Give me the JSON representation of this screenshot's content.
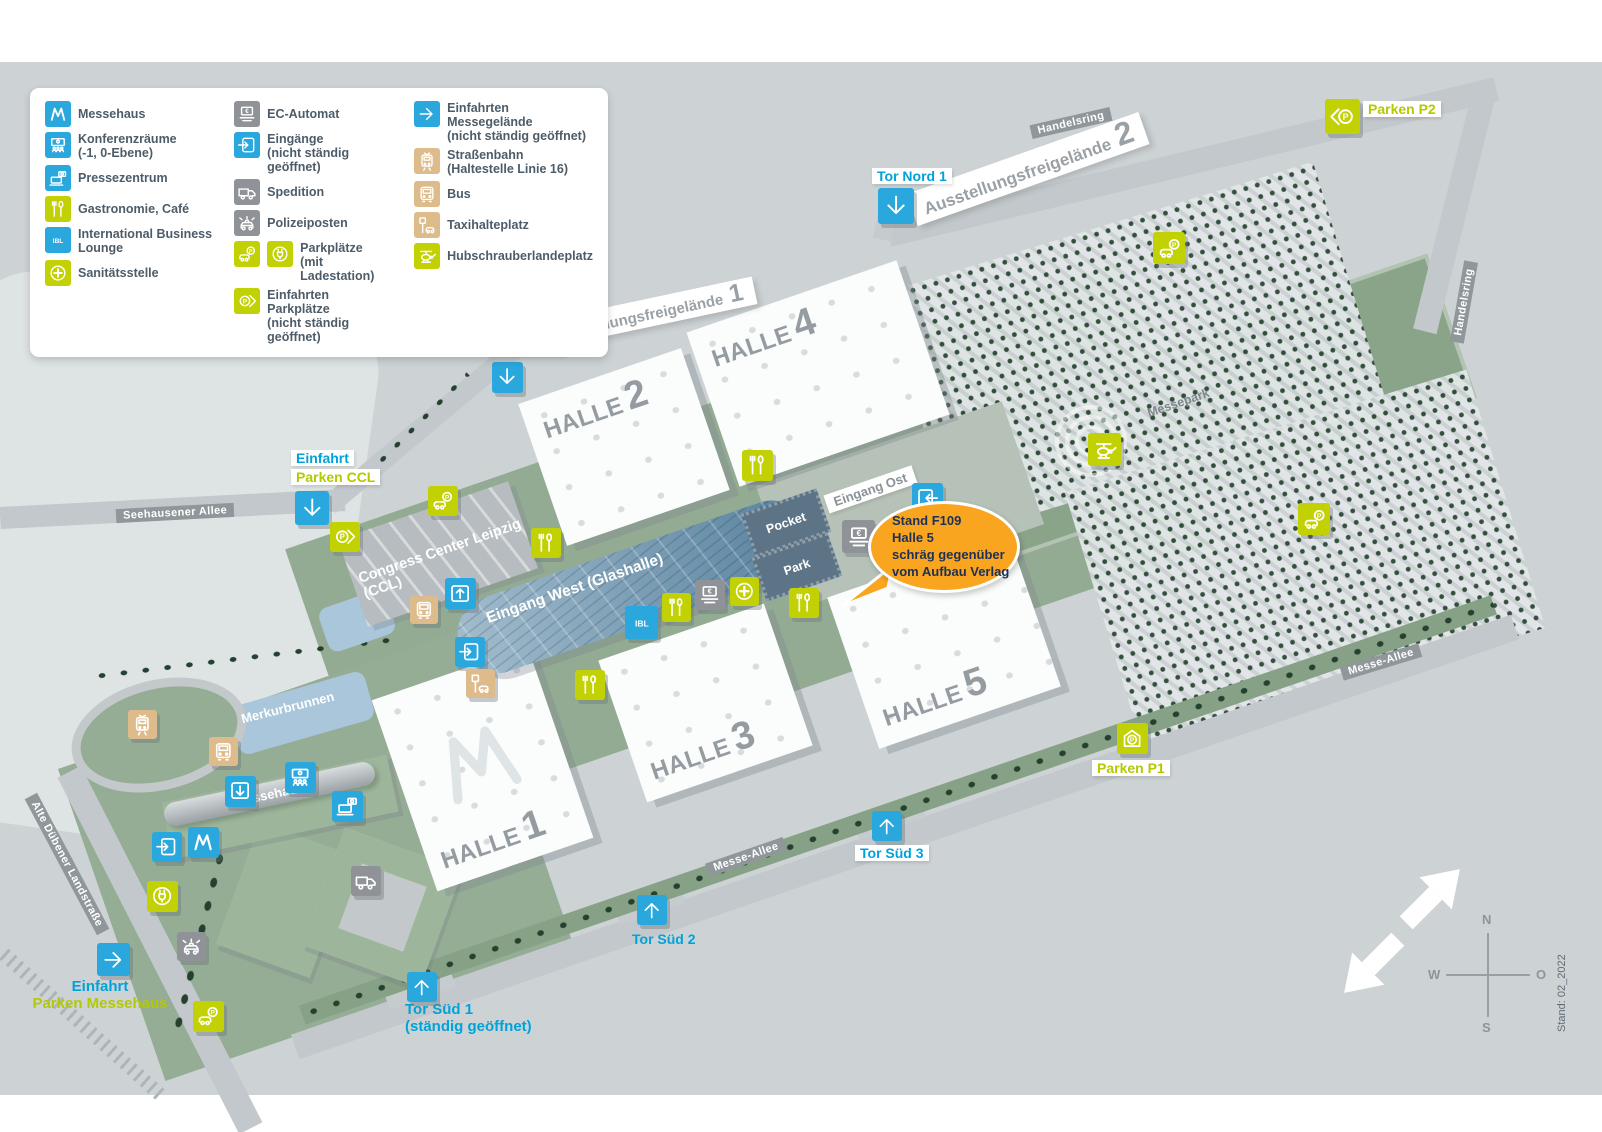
{
  "colors": {
    "blue": "#2aa7dc",
    "lime": "#c2d104",
    "gray": "#8f9397",
    "tan": "#ddbb8b",
    "cyan_text": "#00a3d9",
    "lime_text": "#b3c900",
    "orange": "#f9a51f",
    "navy": "#1d3056",
    "badge_bg": "#8f979b",
    "map_bg": "#cdd3d5",
    "green": "#93ab93",
    "water": "#a9c6da",
    "hall_label": "#959ca1"
  },
  "legend": {
    "columns": [
      [
        {
          "icon": "messehaus-logo",
          "color": "blue",
          "label": "Messehaus"
        },
        {
          "icon": "konferenz",
          "color": "blue",
          "label": "Konferenzräume",
          "sub": "(-1, 0-Ebene)"
        },
        {
          "icon": "presse",
          "color": "blue",
          "label": "Pressezentrum"
        },
        {
          "icon": "gastro",
          "color": "lime",
          "label": "Gastronomie, Café"
        },
        {
          "icon": "ibl",
          "color": "blue",
          "label": "International Business Lounge"
        },
        {
          "icon": "sani",
          "color": "lime",
          "label": "Sanitätsstelle"
        }
      ],
      [
        {
          "icon": "ec",
          "color": "gray",
          "label": "EC-Automat"
        },
        {
          "icon": "eingang",
          "color": "blue",
          "label": "Eingänge",
          "sub": "(nicht ständig geöffnet)"
        },
        {
          "icon": "spedition",
          "color": "gray",
          "label": "Spedition"
        },
        {
          "icon": "polizei",
          "color": "gray",
          "label": "Polizeiposten"
        },
        {
          "icons": [
            "parken",
            "laden"
          ],
          "color": "lime",
          "label": "Parkplätze",
          "sub": "(mit Ladestation)"
        },
        {
          "icon": "einfahrt-p",
          "color": "lime",
          "label": "Einfahrten Parkplätze",
          "sub": "(nicht ständig geöffnet)"
        }
      ],
      [
        {
          "icon": "arrow-right",
          "color": "blue",
          "label": "Einfahrten Messegelände",
          "sub": "(nicht ständig geöffnet)"
        },
        {
          "icon": "tram",
          "color": "tan",
          "label": "Straßenbahn",
          "sub": "(Haltestelle Linie 16)"
        },
        {
          "icon": "bus",
          "color": "tan",
          "label": "Bus"
        },
        {
          "icon": "taxi",
          "color": "tan",
          "label": "Taxihalteplatz"
        },
        {
          "icon": "heli",
          "color": "lime",
          "label": "Hubschrauberlandeplatz"
        }
      ]
    ]
  },
  "halls": [
    {
      "word": "HALLE",
      "num": "1"
    },
    {
      "word": "HALLE",
      "num": "2"
    },
    {
      "word": "HALLE",
      "num": "3"
    },
    {
      "word": "HALLE",
      "num": "4"
    },
    {
      "word": "HALLE",
      "num": "5"
    }
  ],
  "labels": {
    "eingang_west": "Eingang West",
    "glashalle": "(Glashalle)",
    "eingang_ost": "Eingang Ost",
    "ccl_line1": "Congress Center Leipzig",
    "ccl_line2": "(CCL)",
    "messehaus": "Messehaus",
    "merkurbrunnen": "Merkurbrunnen",
    "messepark": "Messepark",
    "pocket1": "Pocket",
    "pocket2": "Park",
    "freigelaende1_text": "Ausstellungsfreigelände",
    "freigelaende1_num": "1",
    "freigelaende2_text": "Ausstellungsfreigelände",
    "freigelaende2_num": "2"
  },
  "roads": {
    "handelsring_top": "Handelsring",
    "handelsring_right": "Handelsring",
    "seehausener": "Seehausener Allee",
    "messe_allee_bottom": "Messe-Allee",
    "messe_allee_right": "Messe-Allee",
    "alte_duebener": "Alte Dübener Landstraße"
  },
  "gates": {
    "tor_nord_1": "Tor Nord 1",
    "tor_nord_2": "Tor Nord 2",
    "tor_sued_1": "Tor Süd 1",
    "tor_sued_1_sub": "(ständig geöffnet)",
    "tor_sued_2": "Tor Süd 2",
    "tor_sued_3": "Tor Süd 3"
  },
  "parken": {
    "p1": "Parken P1",
    "p2": "Parken P2",
    "einfahrt_ccl_1": "Einfahrt",
    "einfahrt_ccl_2": "Parken CCL",
    "einfahrt_messehaus_1": "Einfahrt",
    "einfahrt_messehaus_2": "Parken Messehaus"
  },
  "callout": {
    "line1": "Stand F109",
    "line2": "Halle 5",
    "line3": "schräg gegenüber",
    "line4": "vom Aufbau Verlag"
  },
  "compass": {
    "n": "N",
    "w": "W",
    "o": "O",
    "s": "S"
  },
  "meta": {
    "stand": "Stand: 02_2022"
  },
  "map_icons": [
    {
      "name": "gate-tor-nord-1-icon",
      "icon": "arrow-down",
      "color": "blue",
      "x": 878,
      "y": 188,
      "s": 36
    },
    {
      "name": "gate-tor-nord-2-icon",
      "icon": "arrow-down",
      "color": "blue",
      "x": 492,
      "y": 362,
      "s": 31
    },
    {
      "name": "parken-p2-icon",
      "icon": "einfahrt-p-left",
      "color": "lime",
      "x": 1325,
      "y": 99,
      "s": 35
    },
    {
      "name": "parken-handelsring-icon",
      "icon": "parken",
      "color": "lime",
      "x": 1153,
      "y": 232,
      "s": 32
    },
    {
      "name": "einfahrt-parken-ccl-icon",
      "icon": "arrow-down",
      "color": "blue",
      "x": 295,
      "y": 491,
      "s": 34
    },
    {
      "name": "einfahrt-parkplaetze-ccl-icon",
      "icon": "einfahrt-p",
      "color": "lime",
      "x": 330,
      "y": 522,
      "s": 30
    },
    {
      "name": "parken-ladestation-ccl-icon",
      "icon": "parken",
      "color": "lime",
      "x": 428,
      "y": 486,
      "s": 30
    },
    {
      "name": "eingang-ccl-icon",
      "icon": "eingang-up",
      "color": "blue",
      "x": 445,
      "y": 578,
      "s": 31
    },
    {
      "name": "bus-ccl-icon",
      "icon": "bus",
      "color": "tan",
      "x": 410,
      "y": 596,
      "s": 28
    },
    {
      "name": "eingang-glashalle-sued-icon",
      "icon": "eingang",
      "color": "blue",
      "x": 455,
      "y": 637,
      "s": 30
    },
    {
      "name": "taxi-glashalle-icon",
      "icon": "taxi",
      "color": "tan",
      "x": 466,
      "y": 669,
      "s": 29
    },
    {
      "name": "gastronomie-ccl-icon",
      "icon": "gastro",
      "color": "lime",
      "x": 531,
      "y": 528,
      "s": 30
    },
    {
      "name": "gastronomie-mall-nord-icon",
      "icon": "gastro",
      "color": "lime",
      "x": 742,
      "y": 450,
      "s": 31
    },
    {
      "name": "gastronomie-glashalle-icon",
      "icon": "gastro",
      "color": "lime",
      "x": 662,
      "y": 593,
      "s": 29
    },
    {
      "name": "gastronomie-halle1-nord-icon",
      "icon": "gastro",
      "color": "lime",
      "x": 575,
      "y": 670,
      "s": 30
    },
    {
      "name": "gastronomie-halle5-west-icon",
      "icon": "gastro",
      "color": "lime",
      "x": 789,
      "y": 588,
      "s": 30
    },
    {
      "name": "ibl-icon",
      "icon": "ibl",
      "color": "blue",
      "x": 625,
      "y": 606,
      "s": 33
    },
    {
      "name": "ec-automat-glashalle-icon",
      "icon": "ec",
      "color": "gray",
      "x": 695,
      "y": 580,
      "s": 30
    },
    {
      "name": "sanitaetsstelle-icon",
      "icon": "sani",
      "color": "lime",
      "x": 730,
      "y": 577,
      "s": 29
    },
    {
      "name": "ec-automat-ost-icon",
      "icon": "ec",
      "color": "gray",
      "x": 842,
      "y": 520,
      "s": 33
    },
    {
      "name": "eingang-ost-icon",
      "icon": "eingang-left",
      "color": "blue",
      "x": 912,
      "y": 483,
      "s": 31
    },
    {
      "name": "hubschrauberlandeplatz-icon",
      "icon": "heli",
      "color": "lime",
      "x": 1088,
      "y": 433,
      "s": 33
    },
    {
      "name": "parken-ost-icon",
      "icon": "parken",
      "color": "lime",
      "x": 1298,
      "y": 503,
      "s": 32
    },
    {
      "name": "parken-p1-icon",
      "icon": "parken-haus",
      "color": "lime",
      "x": 1117,
      "y": 723,
      "s": 31
    },
    {
      "name": "gate-tor-sued-3-icon",
      "icon": "arrow-up",
      "color": "blue",
      "x": 872,
      "y": 811,
      "s": 30
    },
    {
      "name": "gate-tor-sued-2-icon",
      "icon": "arrow-up",
      "color": "blue",
      "x": 637,
      "y": 895,
      "s": 30
    },
    {
      "name": "gate-tor-sued-1-icon",
      "icon": "arrow-up",
      "color": "blue",
      "x": 407,
      "y": 972,
      "s": 30
    },
    {
      "name": "tram-icon",
      "icon": "tram",
      "color": "tan",
      "x": 128,
      "y": 710,
      "s": 29
    },
    {
      "name": "bus-schleife-icon",
      "icon": "bus",
      "color": "tan",
      "x": 209,
      "y": 737,
      "s": 29
    },
    {
      "name": "eingang-messehaus-nord-icon",
      "icon": "eingang-down",
      "color": "blue",
      "x": 225,
      "y": 776,
      "s": 31
    },
    {
      "name": "konferenzraeume-icon",
      "icon": "konferenz",
      "color": "blue",
      "x": 285,
      "y": 762,
      "s": 31
    },
    {
      "name": "pressezentrum-icon",
      "icon": "presse",
      "color": "blue",
      "x": 332,
      "y": 791,
      "s": 31
    },
    {
      "name": "messehaus-logo-icon",
      "icon": "messehaus-logo",
      "color": "blue",
      "x": 188,
      "y": 827,
      "s": 31
    },
    {
      "name": "eingang-messehaus-west-icon",
      "icon": "eingang",
      "color": "blue",
      "x": 152,
      "y": 832,
      "s": 30
    },
    {
      "name": "ladestation-messehaus-icon",
      "icon": "laden",
      "color": "lime",
      "x": 147,
      "y": 881,
      "s": 31
    },
    {
      "name": "polizeiposten-icon",
      "icon": "polizei",
      "color": "gray",
      "x": 177,
      "y": 932,
      "s": 29
    },
    {
      "name": "parken-messehaus-icon",
      "icon": "parken",
      "color": "lime",
      "x": 193,
      "y": 1001,
      "s": 31
    },
    {
      "name": "einfahrt-parken-messehaus-icon",
      "icon": "arrow-right",
      "color": "blue",
      "x": 97,
      "y": 943,
      "s": 33
    },
    {
      "name": "spedition-icon",
      "icon": "spedition",
      "color": "gray",
      "x": 351,
      "y": 866,
      "s": 30
    }
  ]
}
